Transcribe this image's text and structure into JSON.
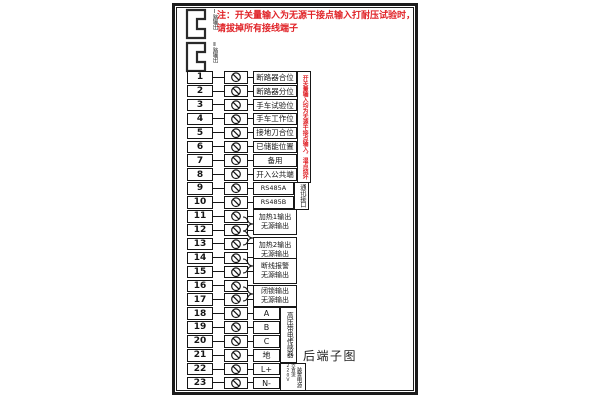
{
  "title": "后端子图",
  "note": {
    "line1": "注：开关量输入为无源干接点输入打耐压试验时，",
    "line2": "请拔掉所有接线端子"
  },
  "connectors": [
    {
      "label": "Ⅰ路输出"
    },
    {
      "label": "Ⅱ路输出"
    }
  ],
  "warning_strip": "开关量输入均为无源干接点输入，湿点烧坏",
  "terminals": [
    {
      "num": "1",
      "label": "断路器合位"
    },
    {
      "num": "2",
      "label": "断路器分位"
    },
    {
      "num": "3",
      "label": "手车试验位"
    },
    {
      "num": "4",
      "label": "手车工作位"
    },
    {
      "num": "5",
      "label": "接地刀合位"
    },
    {
      "num": "6",
      "label": "已储能位置"
    },
    {
      "num": "7",
      "label": "备用"
    },
    {
      "num": "8",
      "label": "开入公共端"
    },
    {
      "num": "9",
      "label": "RS485A"
    },
    {
      "num": "10",
      "label": "RS485B"
    },
    {
      "num": "11",
      "label": ""
    },
    {
      "num": "12",
      "label": ""
    },
    {
      "num": "13",
      "label": ""
    },
    {
      "num": "14",
      "label": ""
    },
    {
      "num": "15",
      "label": ""
    },
    {
      "num": "16",
      "label": ""
    },
    {
      "num": "17",
      "label": ""
    },
    {
      "num": "18",
      "label": "A"
    },
    {
      "num": "19",
      "label": "B"
    },
    {
      "num": "20",
      "label": "C"
    },
    {
      "num": "21",
      "label": "地"
    },
    {
      "num": "22",
      "label": "L+"
    },
    {
      "num": "23",
      "label": "N-"
    }
  ],
  "output_groups": [
    {
      "line1": "加热1输出",
      "line2": "无源输出"
    },
    {
      "line1": "加热2输出",
      "line2": "无源输出"
    },
    {
      "line1": "断线报警",
      "line2": "无源输出"
    },
    {
      "line1": "闭锁输出",
      "line2": "无源输出"
    }
  ],
  "side_boxes": {
    "comm": "通讯接口",
    "sensor": "高压带电传感器",
    "power_name": "装置电源",
    "power_rating": "交直流220V"
  },
  "colors": {
    "line": "#161616",
    "note_red": "#e02227"
  }
}
